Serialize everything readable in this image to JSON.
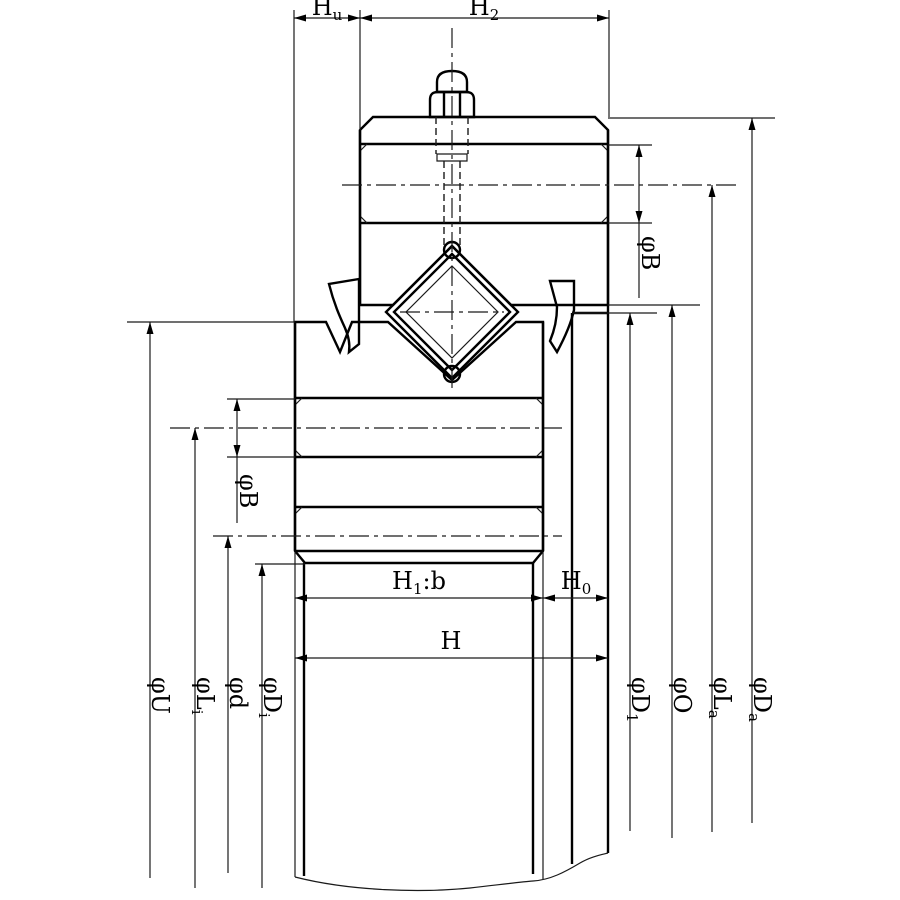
{
  "colors": {
    "ring_teal": "#0CB2B3",
    "outline": "#000000"
  },
  "labels": {
    "hu": {
      "main": "H",
      "sub": "u"
    },
    "h2": {
      "main": "H",
      "sub": "2"
    },
    "h1b": {
      "main": "H",
      "sub": "1",
      "suffix": ":b"
    },
    "h0": {
      "main": "H",
      "sub": "0"
    },
    "h": {
      "main": "H"
    },
    "phi_b_left": {
      "main": "φB"
    },
    "phi_b_right": {
      "main": "φB"
    },
    "phi_u": {
      "main": "φU"
    },
    "phi_li": {
      "main": "φL",
      "sub": "i"
    },
    "phi_d_small": {
      "main": "φd"
    },
    "phi_di": {
      "main": "φD",
      "sub": "i"
    },
    "phi_d1": {
      "main": "φD",
      "sub": "1"
    },
    "phi_o": {
      "main": "φO"
    },
    "phi_la": {
      "main": "φL",
      "sub": "a"
    },
    "phi_da": {
      "main": "φD",
      "sub": "a"
    }
  }
}
